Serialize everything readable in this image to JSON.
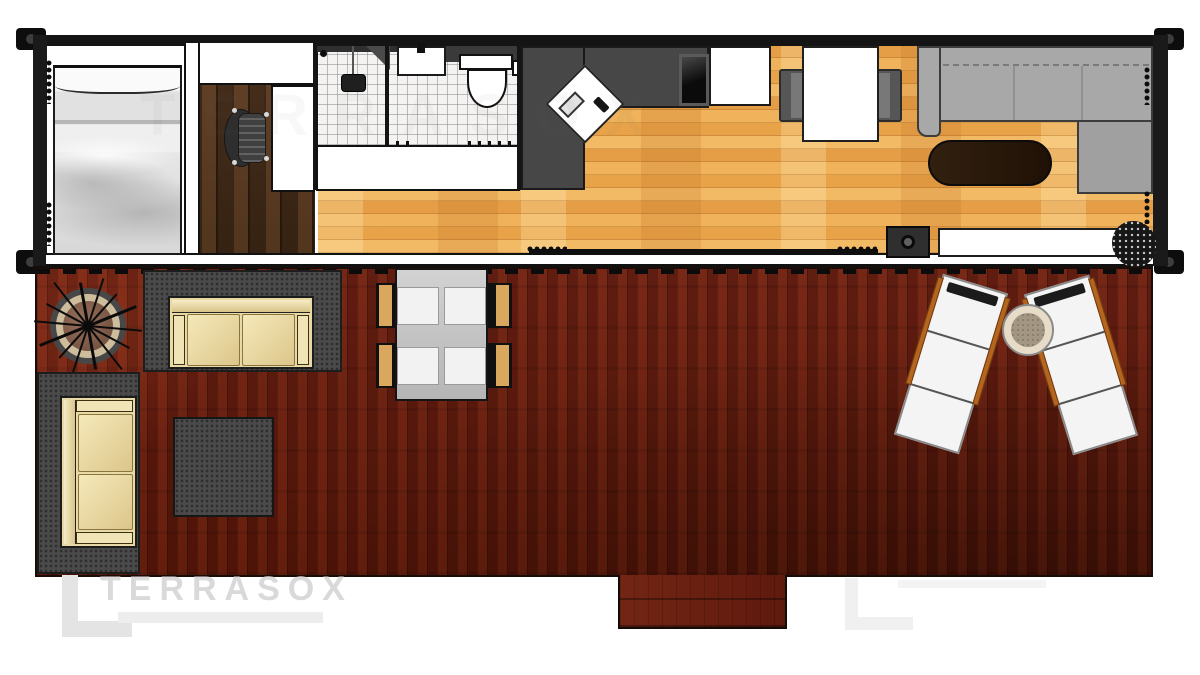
{
  "watermark": {
    "brand": "TERRASOX"
  },
  "palette": {
    "page_bg": "#ffffff",
    "wall_ink": "#141414",
    "deck_wood": "#611b0f",
    "interior_wood": "#eca94f",
    "office_wood": "#47301d",
    "tile": "#f4f3f1",
    "counter_gray": "#474747",
    "sofa_gray": "#a8a8a8",
    "rug_gray": "#4a4a4a",
    "cushion_cream": "#f0e3b4",
    "frame_tan": "#e9d9a4",
    "coffee_table_wood": "#2c1a0c",
    "lounger_rail": "#b5651d",
    "lounger_pad": "#f4f4f4",
    "fire_pit_rim": "#cdbd9c"
  },
  "plan": {
    "structure": "shipping-container-home-with-deck",
    "areas": [
      "bedroom",
      "office",
      "bathroom",
      "kitchen",
      "dining-area",
      "living-room",
      "deck"
    ],
    "furniture": [
      "double-bed",
      "office-chair",
      "desk",
      "shower",
      "bathroom-sink",
      "toilet",
      "kitchen-counter",
      "corner-sink",
      "cooktop",
      "refrigerator",
      "dining-table",
      "dining-chairs",
      "sectional-sofa",
      "coffee-table",
      "wood-stove",
      "tv-cabinet",
      "potted-plant",
      "fire-pit",
      "outdoor-loveseat",
      "outdoor-sofa",
      "ottoman",
      "outdoor-dining-set",
      "sun-loungers",
      "round-side-table",
      "deck-step"
    ]
  }
}
